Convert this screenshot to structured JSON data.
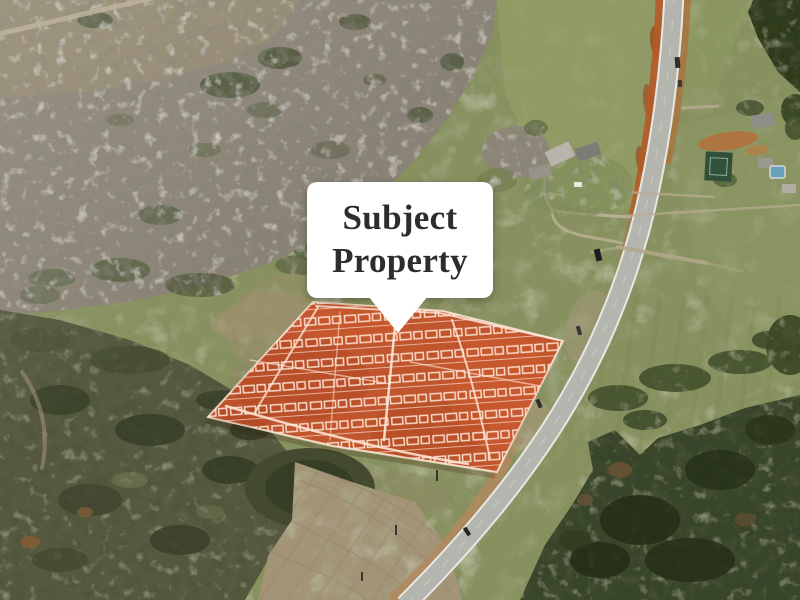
{
  "callout": {
    "label": "Subject Property",
    "background": "#ffffff",
    "text_color": "#2d2d2d"
  },
  "overlay": {
    "label": "Subject Property parcel highlight",
    "fill": "#c4532b",
    "sketch_line_color": "#ffe9da"
  },
  "scene": {
    "type": "oblique-aerial-photo",
    "colors": {
      "field_green": "#87905e",
      "winter_forest_gray": "#8b8376",
      "evergreen_dark": "#39452a",
      "plowed_field_tan": "#a39478",
      "road_asphalt": "#b4b5af",
      "road_edge_line": "#e8e8e2",
      "roadside_dirt_orange": "#b45b29",
      "pool_blue": "#66a0bd",
      "tennis_court_green": "#30503a"
    }
  }
}
